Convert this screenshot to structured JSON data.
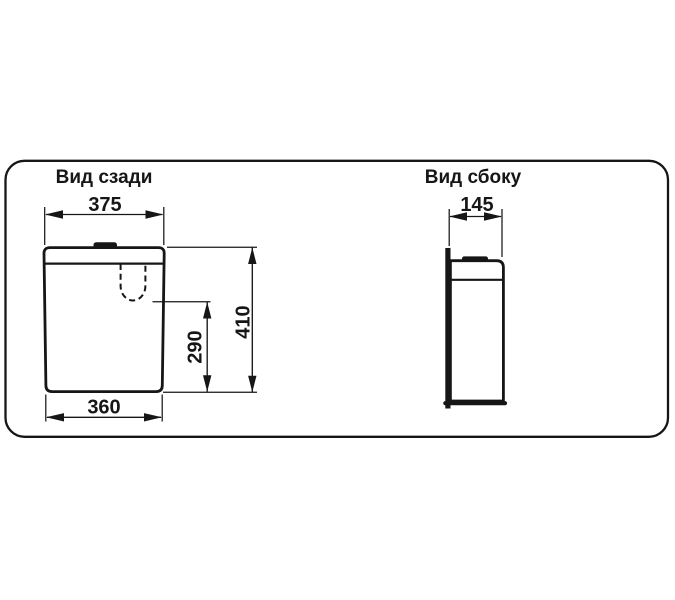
{
  "canvas": {
    "background": "#ffffff",
    "ink": "#161616"
  },
  "views": {
    "rear": {
      "title": "Вид сзади",
      "dims": {
        "top_width": "375",
        "bottom_width": "360",
        "total_height": "410",
        "inlet_height": "290"
      }
    },
    "side": {
      "title": "Вид сбоку",
      "dims": {
        "depth": "145"
      }
    }
  }
}
